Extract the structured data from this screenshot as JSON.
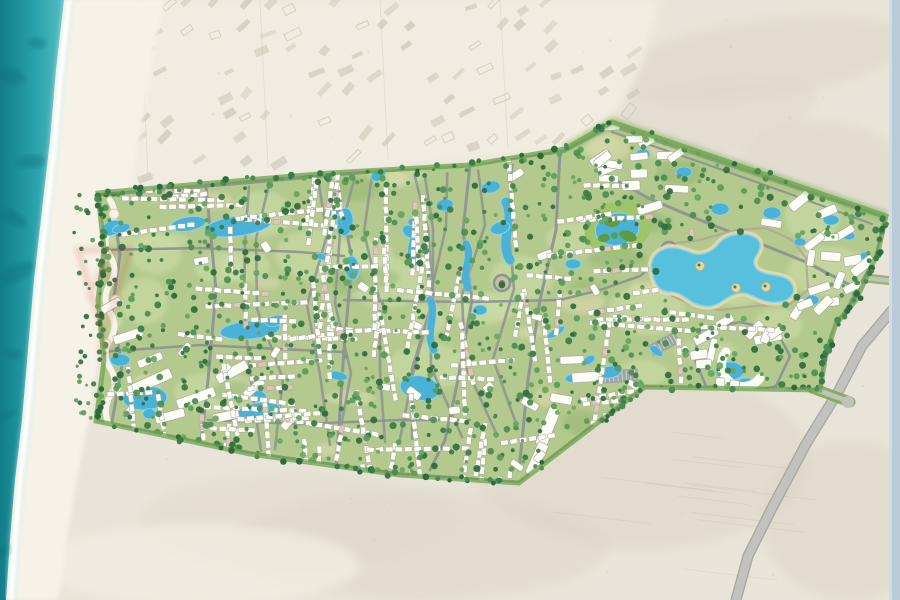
{
  "title": "aerial-masterplan-coastal-resort",
  "palette": {
    "sea_deep": "#117e8a",
    "sea_mid": "#2aa2ac",
    "sea_light": "#55bcc0",
    "sea_patch": "#0d6f7c",
    "foam": "#ffffff",
    "foam_soft": "#d7efe9",
    "beach": "#f7f2e8",
    "bright_sand": "#f3eee3",
    "desert": "#e9e4d9",
    "desert_patch": "#dcd5c6",
    "settlement_bldg": "#c3bdae",
    "faint_line": "#d6d0c2",
    "field_line": "#b7b0a1",
    "plan_green": "#b3c98d",
    "plan_green_light": "#cfdfab",
    "plan_green_dark": "#8db06a",
    "plan_sand": "#e6dcb4",
    "fringe_green": "#6ca24e",
    "fringe_glow": "#79b153",
    "road": "#8e9394",
    "road_major": "#858b8c",
    "ring_tan": "#b3a98e",
    "parking": "#9ba1a2",
    "water": "#49b2d6",
    "water_light": "#8ed4ea",
    "lagoon": "#57c0dd",
    "lagoon_edge": "#e9d9a8",
    "island_sand": "#e8d8a8",
    "island_rim": "#caaf74",
    "building_white": "#fdfdf8",
    "building_stroke": "#a8a699",
    "building_pink": "#e4c3ba",
    "golf_base": "#9fc46a",
    "golf_island": "#5d9c41",
    "highway": "#c2c1bd",
    "highway_edge": "#a6a5a0",
    "verge_green": "#7cab4f",
    "edge_strip": "#b9cbd9",
    "edge_strip_light": "#cfdde8",
    "watermark": "#c0392b",
    "tree_colors": [
      "#2e6b3c",
      "#3a7b46",
      "#4b8d51",
      "#5a9a57",
      "#66a65f"
    ]
  },
  "map": {
    "sea_edge": [
      [
        64,
        0
      ],
      [
        56,
        70
      ],
      [
        50,
        140
      ],
      [
        42,
        210
      ],
      [
        34,
        280
      ],
      [
        28,
        350
      ],
      [
        22,
        420
      ],
      [
        15,
        480
      ],
      [
        10,
        540
      ],
      [
        6,
        600
      ]
    ],
    "beach_width_top": 100,
    "beach_width_bottom": 52,
    "plan_outline": [
      [
        98,
        193
      ],
      [
        200,
        184
      ],
      [
        330,
        173
      ],
      [
        470,
        165
      ],
      [
        565,
        149
      ],
      [
        612,
        122
      ],
      [
        886,
        216
      ],
      [
        878,
        252
      ],
      [
        856,
        300
      ],
      [
        836,
        324
      ],
      [
        826,
        354
      ],
      [
        820,
        390
      ],
      [
        645,
        387
      ],
      [
        600,
        421
      ],
      [
        519,
        483
      ],
      [
        400,
        475
      ],
      [
        250,
        454
      ],
      [
        96,
        421
      ],
      [
        104,
        360
      ],
      [
        98,
        300
      ],
      [
        104,
        250
      ]
    ],
    "ne_zone": [
      [
        565,
        149
      ],
      [
        612,
        122
      ],
      [
        886,
        216
      ],
      [
        876,
        258
      ],
      [
        848,
        300
      ],
      [
        780,
        268
      ],
      [
        700,
        236
      ],
      [
        640,
        208
      ],
      [
        598,
        186
      ]
    ],
    "east_zone": [
      [
        796,
        252
      ],
      [
        876,
        258
      ],
      [
        848,
        300
      ],
      [
        836,
        324
      ],
      [
        826,
        354
      ],
      [
        820,
        388
      ],
      [
        700,
        388
      ],
      [
        696,
        340
      ],
      [
        742,
        300
      ]
    ],
    "lagoon_block": [
      [
        652,
        250
      ],
      [
        700,
        238
      ],
      [
        760,
        230
      ],
      [
        800,
        244
      ],
      [
        810,
        292
      ],
      [
        770,
        306
      ],
      [
        700,
        308
      ],
      [
        660,
        294
      ]
    ],
    "top_edge": [
      [
        75,
        193
      ],
      [
        200,
        185
      ],
      [
        330,
        174
      ],
      [
        470,
        166
      ],
      [
        565,
        150
      ],
      [
        612,
        124
      ]
    ],
    "lagoon_path": "M652,272 C648,258 660,246 676,248 C690,250 694,258 708,252 C720,247 718,238 734,235 C750,232 762,238 760,248 C758,256 750,260 756,268 C764,278 786,272 792,284 C798,296 786,304 770,302 C754,300 750,290 736,294 C722,298 720,308 704,306 C688,304 684,292 670,292 C658,292 654,282 652,272 Z",
    "lagoon_islands": [
      [
        700,
        266
      ],
      [
        736,
        288
      ],
      [
        766,
        287
      ]
    ],
    "roads_main": [
      {
        "pts": [
          [
            100,
            195
          ],
          [
            300,
            178
          ],
          [
            470,
            163
          ],
          [
            565,
            151
          ]
        ],
        "w": 3.5
      },
      {
        "pts": [
          [
            565,
            151
          ],
          [
            612,
            126
          ],
          [
            886,
            218
          ]
        ],
        "w": 3
      },
      {
        "pts": [
          [
            886,
            218
          ],
          [
            876,
            256
          ],
          [
            852,
            300
          ],
          [
            836,
            326
          ],
          [
            824,
            356
          ],
          [
            820,
            390
          ]
        ],
        "w": 3
      },
      {
        "pts": [
          [
            820,
            390
          ],
          [
            700,
            389
          ],
          [
            645,
            387
          ]
        ],
        "w": 3.5
      },
      {
        "pts": [
          [
            645,
            387
          ],
          [
            598,
            422
          ],
          [
            519,
            483
          ]
        ],
        "w": 3
      },
      {
        "pts": [
          [
            519,
            483
          ],
          [
            400,
            474
          ],
          [
            250,
            453
          ],
          [
            96,
            421
          ]
        ],
        "w": 3.5
      },
      {
        "pts": [
          [
            112,
            200
          ],
          [
            120,
            255
          ],
          [
            112,
            310
          ],
          [
            122,
            365
          ],
          [
            112,
            422
          ]
        ],
        "w": 3
      },
      {
        "pts": [
          [
            206,
            186
          ],
          [
            216,
            290
          ],
          [
            208,
            380
          ],
          [
            200,
            452
          ]
        ],
        "w": 3
      },
      {
        "pts": [
          [
            336,
            175
          ],
          [
            352,
            260
          ],
          [
            344,
            350
          ],
          [
            336,
            470
          ]
        ],
        "w": 3
      },
      {
        "pts": [
          [
            470,
            165
          ],
          [
            463,
            230
          ],
          [
            472,
            300
          ],
          [
            458,
            380
          ],
          [
            445,
            440
          ],
          [
            430,
            470
          ]
        ],
        "w": 3
      },
      {
        "pts": [
          [
            560,
            152
          ],
          [
            556,
            230
          ],
          [
            540,
            300
          ],
          [
            528,
            380
          ],
          [
            519,
            470
          ]
        ],
        "w": 3
      },
      {
        "pts": [
          [
            104,
            250
          ],
          [
            200,
            248
          ],
          [
            300,
            252
          ],
          [
            344,
            256
          ]
        ],
        "w": 2.5
      },
      {
        "pts": [
          [
            100,
            352
          ],
          [
            200,
            345
          ],
          [
            300,
            350
          ],
          [
            344,
            352
          ]
        ],
        "w": 2.5
      },
      {
        "pts": [
          [
            344,
            300
          ],
          [
            470,
            302
          ],
          [
            560,
            300
          ]
        ],
        "w": 2.5
      },
      {
        "pts": [
          [
            208,
            420
          ],
          [
            300,
            424
          ],
          [
            400,
            420
          ],
          [
            470,
            420
          ]
        ],
        "w": 2.5
      },
      {
        "pts": [
          [
            598,
            170
          ],
          [
            648,
            198
          ],
          [
            700,
            220
          ],
          [
            756,
            242
          ],
          [
            806,
            262
          ],
          [
            852,
            286
          ]
        ],
        "w": 3
      },
      {
        "pts": [
          [
            612,
            132
          ],
          [
            700,
            162
          ],
          [
            790,
            194
          ],
          [
            872,
            224
          ]
        ],
        "w": 2.2
      },
      {
        "pts": [
          [
            852,
            286
          ],
          [
            856,
            316
          ],
          [
            840,
            344
          ],
          [
            828,
            372
          ],
          [
            822,
            390
          ]
        ],
        "w": 2.5
      },
      {
        "pts": [
          [
            560,
            300
          ],
          [
            600,
            290
          ],
          [
            640,
            276
          ],
          [
            669,
            252
          ]
        ],
        "w": 2.5
      },
      {
        "pts": [
          [
            700,
            330
          ],
          [
            740,
            322
          ],
          [
            776,
            330
          ],
          [
            790,
            356
          ],
          [
            776,
            386
          ],
          [
            736,
            396
          ],
          [
            706,
            386
          ],
          [
            694,
            358
          ],
          [
            700,
            330
          ]
        ],
        "w": 2.5
      }
    ],
    "lagoon_ring": [
      [
        652,
        266
      ],
      [
        668,
        244
      ],
      [
        700,
        240
      ],
      [
        736,
        230
      ],
      [
        766,
        228
      ],
      [
        792,
        240
      ],
      [
        806,
        258
      ],
      [
        808,
        290
      ],
      [
        790,
        304
      ],
      [
        756,
        306
      ],
      [
        720,
        310
      ],
      [
        690,
        304
      ],
      [
        664,
        292
      ],
      [
        652,
        266
      ]
    ],
    "water_ribbons": [
      {
        "d": "M412,222 C420,236 406,248 414,262",
        "w": 7
      },
      {
        "d": "M466,244 C474,258 460,272 468,288",
        "w": 7
      },
      {
        "d": "M506,202 C516,222 498,240 510,260",
        "w": 9
      },
      {
        "d": "M430,300 C438,316 424,332 434,350",
        "w": 7
      }
    ],
    "lagoons": [
      {
        "x": 238,
        "y": 226,
        "rx": 34,
        "ry": 10,
        "r": -8
      },
      {
        "x": 250,
        "y": 330,
        "rx": 30,
        "ry": 9,
        "r": -5
      },
      {
        "x": 188,
        "y": 224,
        "rx": 18,
        "ry": 7,
        "r": -10
      },
      {
        "x": 145,
        "y": 398,
        "rx": 22,
        "ry": 12,
        "r": -3
      },
      {
        "x": 120,
        "y": 360,
        "rx": 10,
        "ry": 6,
        "r": 0
      },
      {
        "x": 258,
        "y": 411,
        "rx": 22,
        "ry": 8,
        "r": -10
      },
      {
        "x": 420,
        "y": 388,
        "rx": 20,
        "ry": 12,
        "r": 10
      },
      {
        "x": 345,
        "y": 222,
        "rx": 8,
        "ry": 14,
        "r": 5
      },
      {
        "x": 352,
        "y": 268,
        "rx": 7,
        "ry": 12,
        "r": -5
      },
      {
        "x": 500,
        "y": 228,
        "rx": 10,
        "ry": 6,
        "r": -15
      },
      {
        "x": 573,
        "y": 264,
        "rx": 8,
        "ry": 5,
        "r": 0
      },
      {
        "x": 610,
        "y": 372,
        "rx": 12,
        "ry": 6,
        "r": -10
      },
      {
        "x": 578,
        "y": 378,
        "rx": 13,
        "ry": 5,
        "r": -4
      },
      {
        "x": 480,
        "y": 310,
        "rx": 7,
        "ry": 5,
        "r": 0
      },
      {
        "x": 112,
        "y": 228,
        "rx": 12,
        "ry": 7,
        "r": -20
      }
    ],
    "ponds_ne": [
      [
        643,
        154,
        7,
        5
      ],
      [
        684,
        172,
        8,
        5
      ],
      [
        720,
        209,
        9,
        6
      ],
      [
        772,
        213,
        9,
        6
      ],
      [
        831,
        220,
        8,
        5
      ],
      [
        849,
        236,
        6,
        4
      ],
      [
        800,
        242,
        6,
        4
      ],
      [
        865,
        256,
        5,
        4
      ],
      [
        852,
        288,
        6,
        4
      ],
      [
        812,
        300,
        7,
        5
      ],
      [
        730,
        371,
        14,
        9
      ],
      [
        746,
        385,
        10,
        7
      ]
    ],
    "buildings_large": [
      [
        150,
        382,
        46,
        11,
        -24
      ],
      [
        196,
        398,
        40,
        10,
        -20
      ],
      [
        232,
        372,
        34,
        10,
        -28
      ],
      [
        128,
        336,
        30,
        9,
        -18
      ],
      [
        170,
        416,
        30,
        9,
        -15
      ],
      [
        150,
        360,
        26,
        8,
        -22
      ],
      [
        226,
        416,
        26,
        9,
        -12
      ],
      [
        110,
        306,
        24,
        8,
        -30
      ],
      [
        254,
        388,
        24,
        8,
        -40
      ],
      [
        290,
        420,
        22,
        8,
        -50
      ],
      [
        572,
        360,
        24,
        8,
        -2
      ],
      [
        587,
        377,
        30,
        10,
        -4
      ],
      [
        561,
        399,
        22,
        9,
        10
      ],
      [
        548,
        427,
        12,
        40,
        22
      ],
      [
        537,
        459,
        11,
        34,
        24
      ],
      [
        530,
        404,
        18,
        8,
        30
      ],
      [
        706,
        336,
        26,
        9,
        -28
      ],
      [
        768,
        338,
        28,
        9,
        -12
      ],
      [
        700,
        398,
        20,
        8,
        6
      ],
      [
        778,
        392,
        18,
        8,
        0
      ],
      [
        748,
        408,
        16,
        8,
        -4
      ],
      [
        610,
        418,
        16,
        8,
        15
      ]
    ],
    "roundabouts": [
      [
        669,
        250
      ],
      [
        502,
        283
      ]
    ],
    "parking": [
      [
        620,
        376,
        36,
        13,
        -4
      ],
      [
        664,
        344,
        30,
        12,
        -28
      ],
      [
        702,
        392,
        30,
        12,
        -6
      ]
    ],
    "golf": {
      "cx": 618,
      "cy": 228
    },
    "highway": {
      "path": [
        [
          894,
          308
        ],
        [
          862,
          346
        ],
        [
          838,
          392
        ],
        [
          806,
          444
        ],
        [
          772,
          508
        ],
        [
          748,
          556
        ],
        [
          736,
          600
        ]
      ],
      "entrance": [
        [
          812,
          388
        ],
        [
          850,
          402
        ]
      ],
      "stub": [
        [
          866,
          278
        ],
        [
          893,
          281
        ]
      ],
      "junction": [
        848,
        402
      ]
    },
    "promenade_nodes": [
      [
        114,
        214
      ],
      [
        106,
        256
      ],
      [
        116,
        300
      ],
      [
        106,
        344
      ],
      [
        116,
        388
      ]
    ],
    "watermark": {
      "tri": "M78,250 L130,250 L104,335 Z",
      "chev": "M88,300 L104,262 L120,300"
    },
    "generator": {
      "seed": 1337,
      "trees_plan": 1000,
      "trees_fringe": 170,
      "trees_beach": 36,
      "house_rows": 100,
      "ne_blocks": 26,
      "east_blocks": 16,
      "extra_blocks": 20,
      "pools_random": 14,
      "green_blobs": 26,
      "sand_blobs": 14,
      "dark_blobs": 10,
      "settlement_rows": [
        8,
        30,
        52,
        74,
        96,
        118,
        140,
        162,
        180
      ],
      "field_lines": 12,
      "desert_speckles": 70,
      "road_wavies": 10,
      "sea_patches": 8
    }
  }
}
